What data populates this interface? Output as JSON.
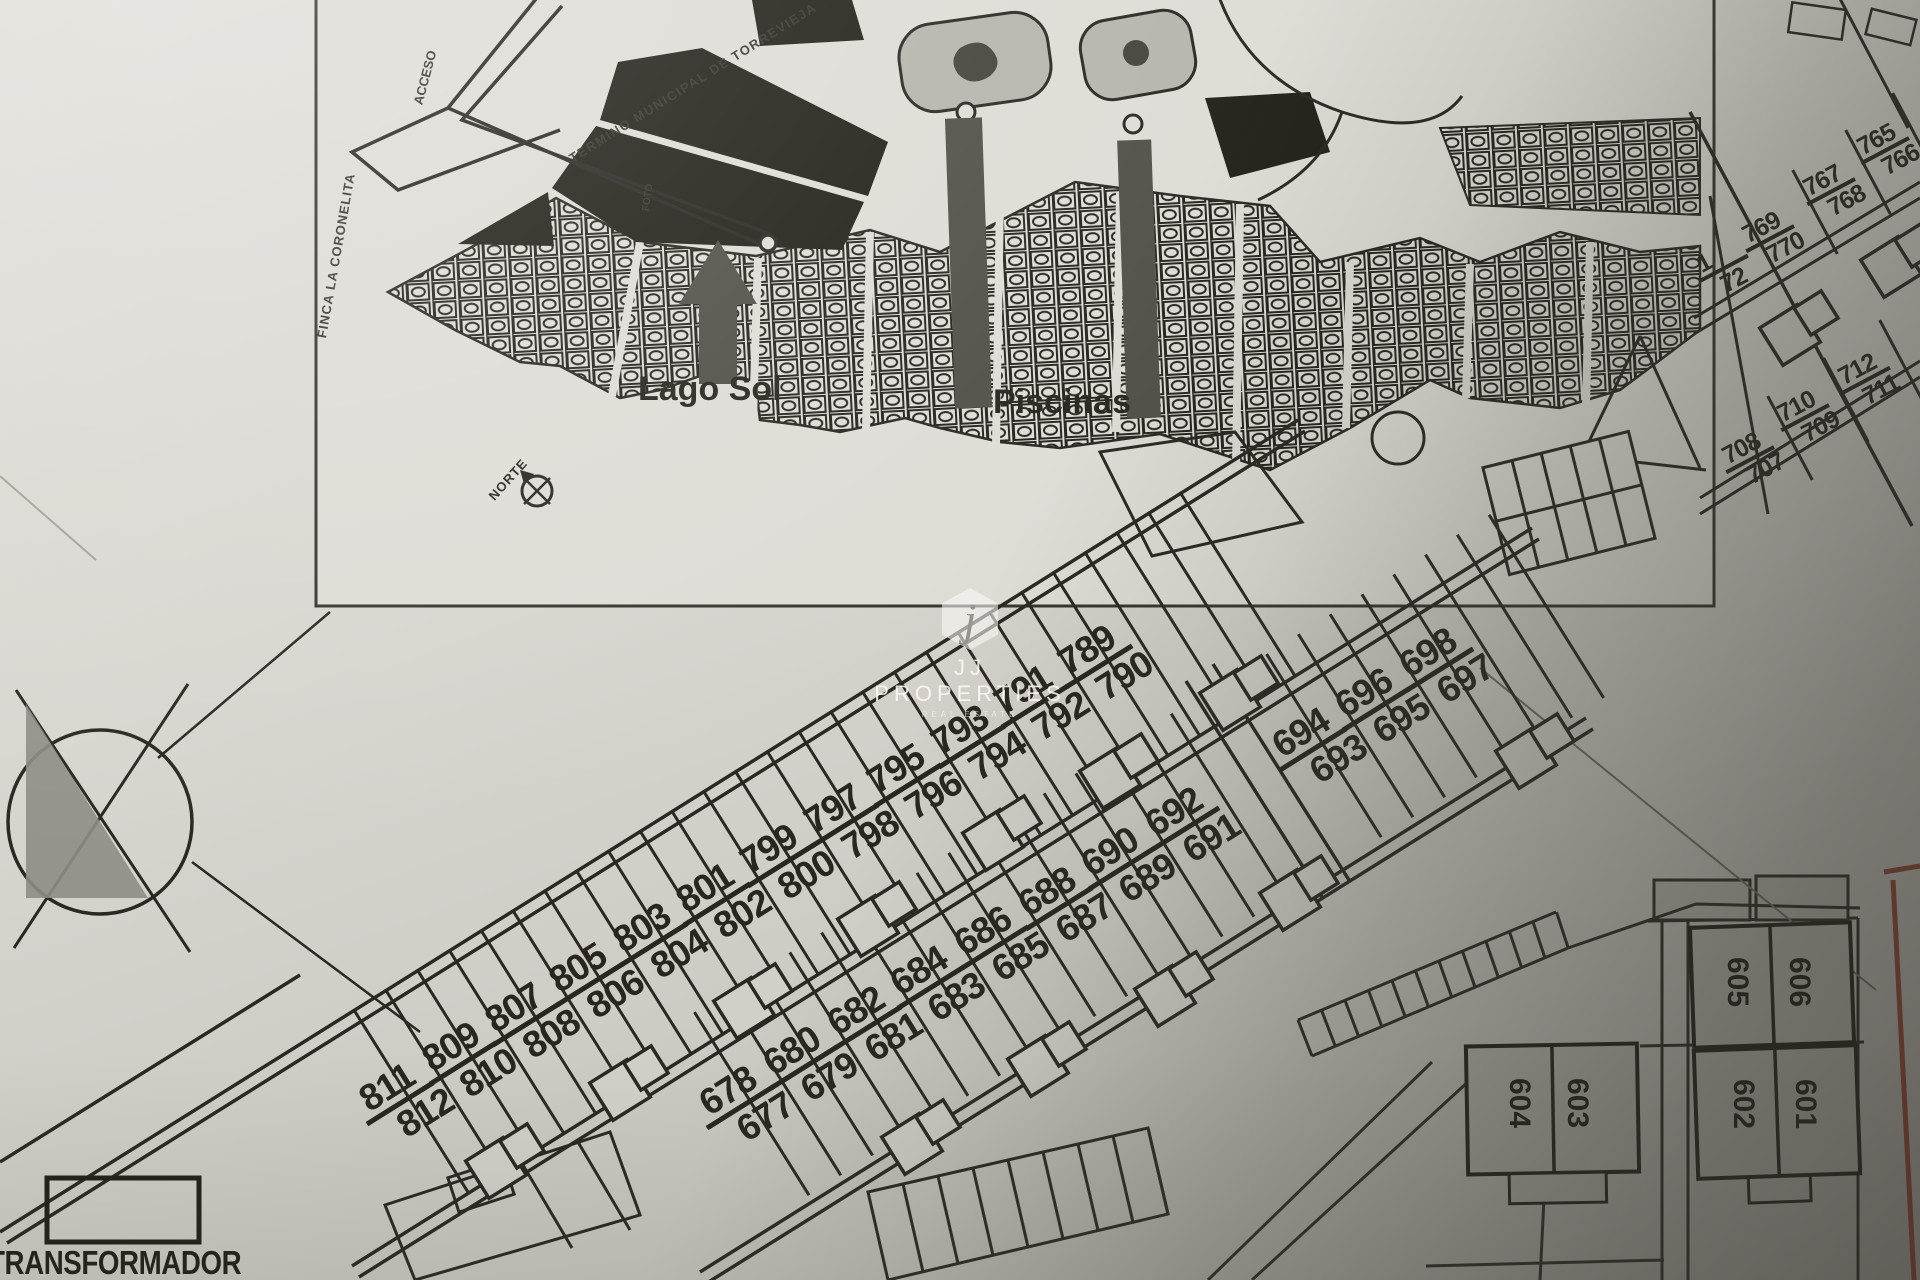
{
  "inset_map": {
    "municipal_boundary_label": "TERMINO MUNICIPAL DE TORREVIEJA",
    "finca_label": "FINCA LA CORONELITA",
    "access_road_label": "ACCESO",
    "photo_label": "FOTO",
    "lake_label": "Lago Sol",
    "pools_label": "Piscinas",
    "north_label": "NORTE"
  },
  "watermark": {
    "monogram": "j",
    "name": "JJ PROPERTIES",
    "tagline": "REAL ESTATE"
  },
  "transformer_label": "TRANSFORMADOR",
  "plot_pairs_band1": [
    {
      "t": "789",
      "b": "790",
      "x": 1110,
      "y": 663
    },
    {
      "t": "791",
      "b": "792",
      "x": 1046,
      "y": 703
    },
    {
      "t": "793",
      "b": "794",
      "x": 983,
      "y": 743
    },
    {
      "t": "795",
      "b": "796",
      "x": 919,
      "y": 782
    },
    {
      "t": "797",
      "b": "798",
      "x": 856,
      "y": 822
    },
    {
      "t": "799",
      "b": "800",
      "x": 792,
      "y": 862
    },
    {
      "t": "801",
      "b": "802",
      "x": 728,
      "y": 901
    },
    {
      "t": "803",
      "b": "804",
      "x": 665,
      "y": 941
    },
    {
      "t": "805",
      "b": "806",
      "x": 601,
      "y": 981
    },
    {
      "t": "807",
      "b": "808",
      "x": 537,
      "y": 1021
    },
    {
      "t": "809",
      "b": "810",
      "x": 474,
      "y": 1060
    },
    {
      "t": "811",
      "b": "812",
      "x": 411,
      "y": 1100
    }
  ],
  "plot_pairs_band2": [
    {
      "t": "698",
      "b": "697",
      "x": 1451,
      "y": 666
    },
    {
      "t": "696",
      "b": "695",
      "x": 1387,
      "y": 706
    },
    {
      "t": "694",
      "b": "693",
      "x": 1324,
      "y": 746
    },
    {
      "t": "692",
      "b": "691",
      "x": 1197,
      "y": 825
    },
    {
      "t": "690",
      "b": "689",
      "x": 1133,
      "y": 865
    },
    {
      "t": "688",
      "b": "687",
      "x": 1070,
      "y": 905
    },
    {
      "t": "686",
      "b": "685",
      "x": 1006,
      "y": 944
    },
    {
      "t": "684",
      "b": "683",
      "x": 942,
      "y": 984
    },
    {
      "t": "682",
      "b": "681",
      "x": 879,
      "y": 1024
    },
    {
      "t": "680",
      "b": "679",
      "x": 815,
      "y": 1064
    },
    {
      "t": "678",
      "b": "677",
      "x": 751,
      "y": 1104
    }
  ],
  "plot_pairs_right": [
    {
      "t": "765",
      "b": "766",
      "x": 1896,
      "y": 150
    },
    {
      "t": "767",
      "b": "768",
      "x": 1842,
      "y": 191
    },
    {
      "t": "769",
      "b": "770",
      "x": 1781,
      "y": 238
    },
    {
      "t": "1",
      "b": "72",
      "x": 1735,
      "y": 268
    },
    {
      "t": "712",
      "b": "711",
      "x": 1877,
      "y": 380
    },
    {
      "t": "710",
      "b": "709",
      "x": 1816,
      "y": 417
    },
    {
      "t": "708",
      "b": "707",
      "x": 1761,
      "y": 459
    }
  ],
  "building_units": [
    {
      "left": "605",
      "right": "606",
      "lx": 1738,
      "rx": 1800,
      "y": 982
    },
    {
      "left": "604",
      "right": "603",
      "lx": 1520,
      "rx": 1578,
      "y": 1103
    },
    {
      "left": "602",
      "right": "601",
      "lx": 1744,
      "rx": 1806,
      "y": 1104
    }
  ],
  "colors": {
    "ink": "#2b2723",
    "paper": "#d8d5cf",
    "building_fill": "#b8b5ae",
    "boundary_red": "#8f4130",
    "arrow_gray": "#524f48"
  }
}
